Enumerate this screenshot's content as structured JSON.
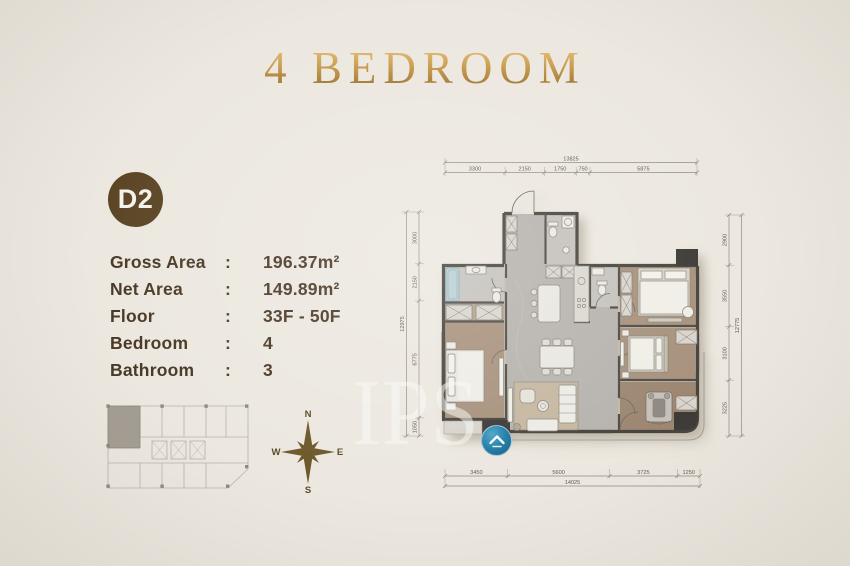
{
  "title": "4 BEDROOM",
  "badge": {
    "label": "D2"
  },
  "details": {
    "rows": [
      {
        "label": "Gross Area",
        "sep": ":",
        "value": "196.37m²"
      },
      {
        "label": "Net Area",
        "sep": ":",
        "value": "149.89m²"
      },
      {
        "label": "Floor",
        "sep": ":",
        "value": "33F - 50F"
      },
      {
        "label": "Bedroom",
        "sep": ":",
        "value": "4"
      },
      {
        "label": "Bathroom",
        "sep": ":",
        "value": "3"
      }
    ]
  },
  "compass": {
    "n": "N",
    "e": "E",
    "s": "S",
    "w": "W"
  },
  "watermark": {
    "text": "IPS",
    "logo_icon": "roof-chevron-icon"
  },
  "floor_plan": {
    "dim_top": {
      "total": "13825",
      "segments": [
        "3300",
        "2150",
        "1750",
        "750",
        "5875"
      ]
    },
    "dim_bottom": {
      "total": "14025",
      "segments": [
        "3450",
        "5600",
        "3725",
        "1250"
      ]
    },
    "dim_left": {
      "total": "12975",
      "segments": [
        "3000",
        "2150",
        "6775",
        "1050"
      ]
    },
    "dim_right": {
      "total": "12775",
      "segments": [
        "2900",
        "3550",
        "3100",
        "3225"
      ]
    }
  },
  "colors": {
    "background": "#ece8e0",
    "gold": "#b08a42",
    "brown": "#5b4525",
    "text": "#4a3926",
    "wall": "#47443e",
    "marble": "#b7b3ae",
    "wood": "#a8927d",
    "blue": "#2b85ad"
  }
}
